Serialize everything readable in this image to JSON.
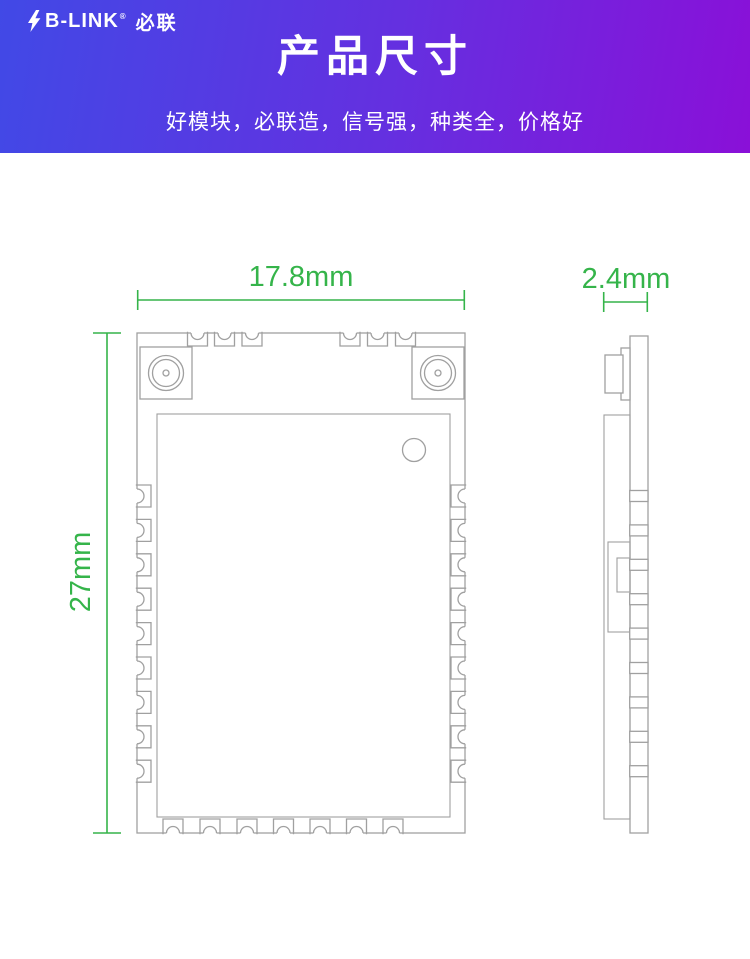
{
  "brand": {
    "name": "B-LINK",
    "registered_mark": "®",
    "name_cn": "必联",
    "icon": "lightning-bolt-icon"
  },
  "banner": {
    "title": "产品尺寸",
    "subtitle": "好模块，必联造，信号强，种类全，价格好",
    "gradient_left": "#4149e6",
    "gradient_right": "#8a10d8",
    "text_color": "#ffffff"
  },
  "diagram": {
    "front_view": {
      "width_label": "17.8mm",
      "height_label": "27mm"
    },
    "side_view": {
      "thickness_label": "2.4mm"
    },
    "dimension_color": "#35b44a",
    "line_color": "#a0a0a0",
    "background": "#ffffff"
  }
}
